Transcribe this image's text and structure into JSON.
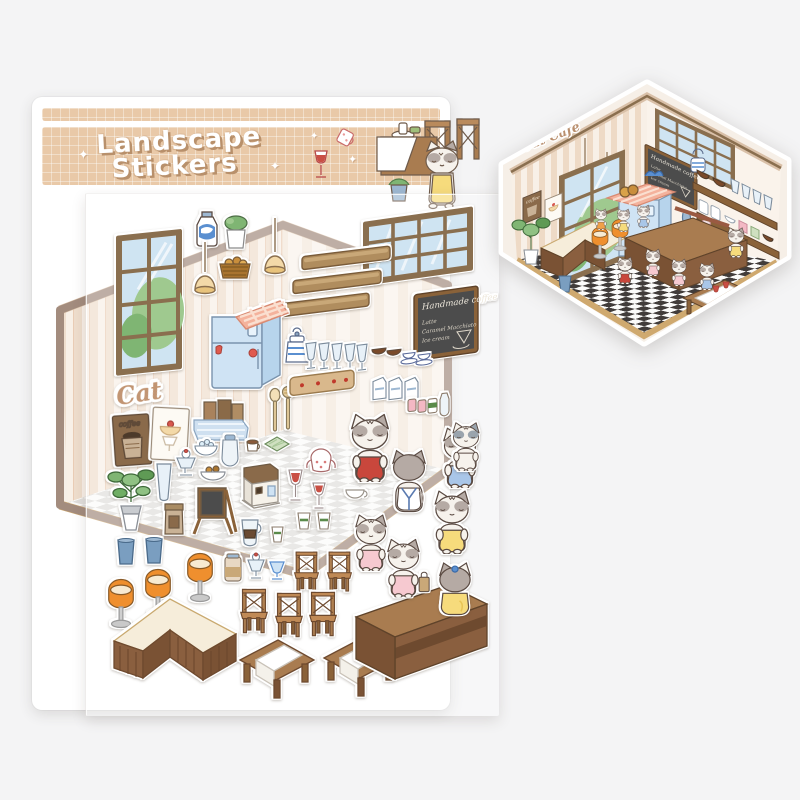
{
  "product": {
    "kind": "sticker-sheet-product-photo",
    "header": {
      "title_line1": "Landscape",
      "title_line2": "Stickers",
      "sparkle_glyph": "✦"
    },
    "sheet": {
      "cat_cafe_sign": "Cat Cafe",
      "coffee_poster_label": "coffee",
      "chalkboard": {
        "heading": "Handmade coffee",
        "line1": "Latte",
        "line2": "Caramel Macchiato",
        "line3": "Ice cream"
      },
      "sticker_inventory": [
        "milk-bottle",
        "potted-plant",
        "hanging-lamp",
        "hanging-lamp",
        "bread-basket",
        "tall-window",
        "wide-window",
        "wood-shelf-plank",
        "wood-shelf-plank",
        "wood-shelf-plank",
        "menu-chalkboard",
        "refrigerator-with-gingham-cloth",
        "cat-cafe-script-sign",
        "coffee-poster",
        "dessert-poster",
        "paper-bag-basket",
        "coat-rack",
        "kettle",
        "parfait-glass-row",
        "cups-and-bowls-row",
        "milk-carton-row",
        "bottle-and-cup-row",
        "spoon",
        "honey-dipper",
        "potted-tree",
        "tall-glass",
        "sundae",
        "ice-bowl",
        "sugar-jar",
        "snack-bowl",
        "coffee-bag",
        "menu-easel",
        "coffee-machine",
        "cocoa-cup",
        "green-cloth",
        "drip-pot",
        "paper-cup",
        "paper-cup",
        "paper-cup",
        "wine-glass",
        "wine-glass",
        "teapot",
        "white-cup",
        "trash-bin",
        "trash-bin",
        "milkshake-jar",
        "parfait",
        "blue-goblet",
        "swivel-stool",
        "swivel-stool",
        "swivel-stool",
        "dining-chair",
        "dining-chair",
        "dining-chair",
        "dining-chair",
        "dining-chair",
        "l-shaped-counter",
        "cafe-table",
        "cafe-table",
        "long-counter",
        "cat-red-shirt",
        "cat-blue-apron-back",
        "cat-blue-shirt",
        "cat-yellow-apron",
        "cat-pink-dress-kitten",
        "cat-pink-dress-with-bag",
        "cat-gray-kitten",
        "cat-yellow-back"
      ]
    },
    "assembled_sticker": {
      "shape": "hexagon-die-cut",
      "cat_cafe_sign": "Cat Cafe",
      "chalkboard": {
        "heading": "Handmade coffee",
        "line1": "Latte",
        "line2": "Caramel Macchiato",
        "line3": "Ice cream"
      },
      "coffee_poster_label": "coffee"
    },
    "colors": {
      "background": "#f4f4f5",
      "header_tan": "#e9c9a8",
      "title_shadow_brown": "#b8906b",
      "wallpaper_stripe": "#eedcca",
      "wood": "#a97c50",
      "wood_dark": "#7a5234",
      "fridge_blue": "#cfe3f4",
      "gingham_pink": "#f4b29c",
      "stool_orange": "#ef8f2e",
      "cat_gray": "#b5aaa4",
      "floor_checker_dark": "#3f3a38"
    }
  }
}
